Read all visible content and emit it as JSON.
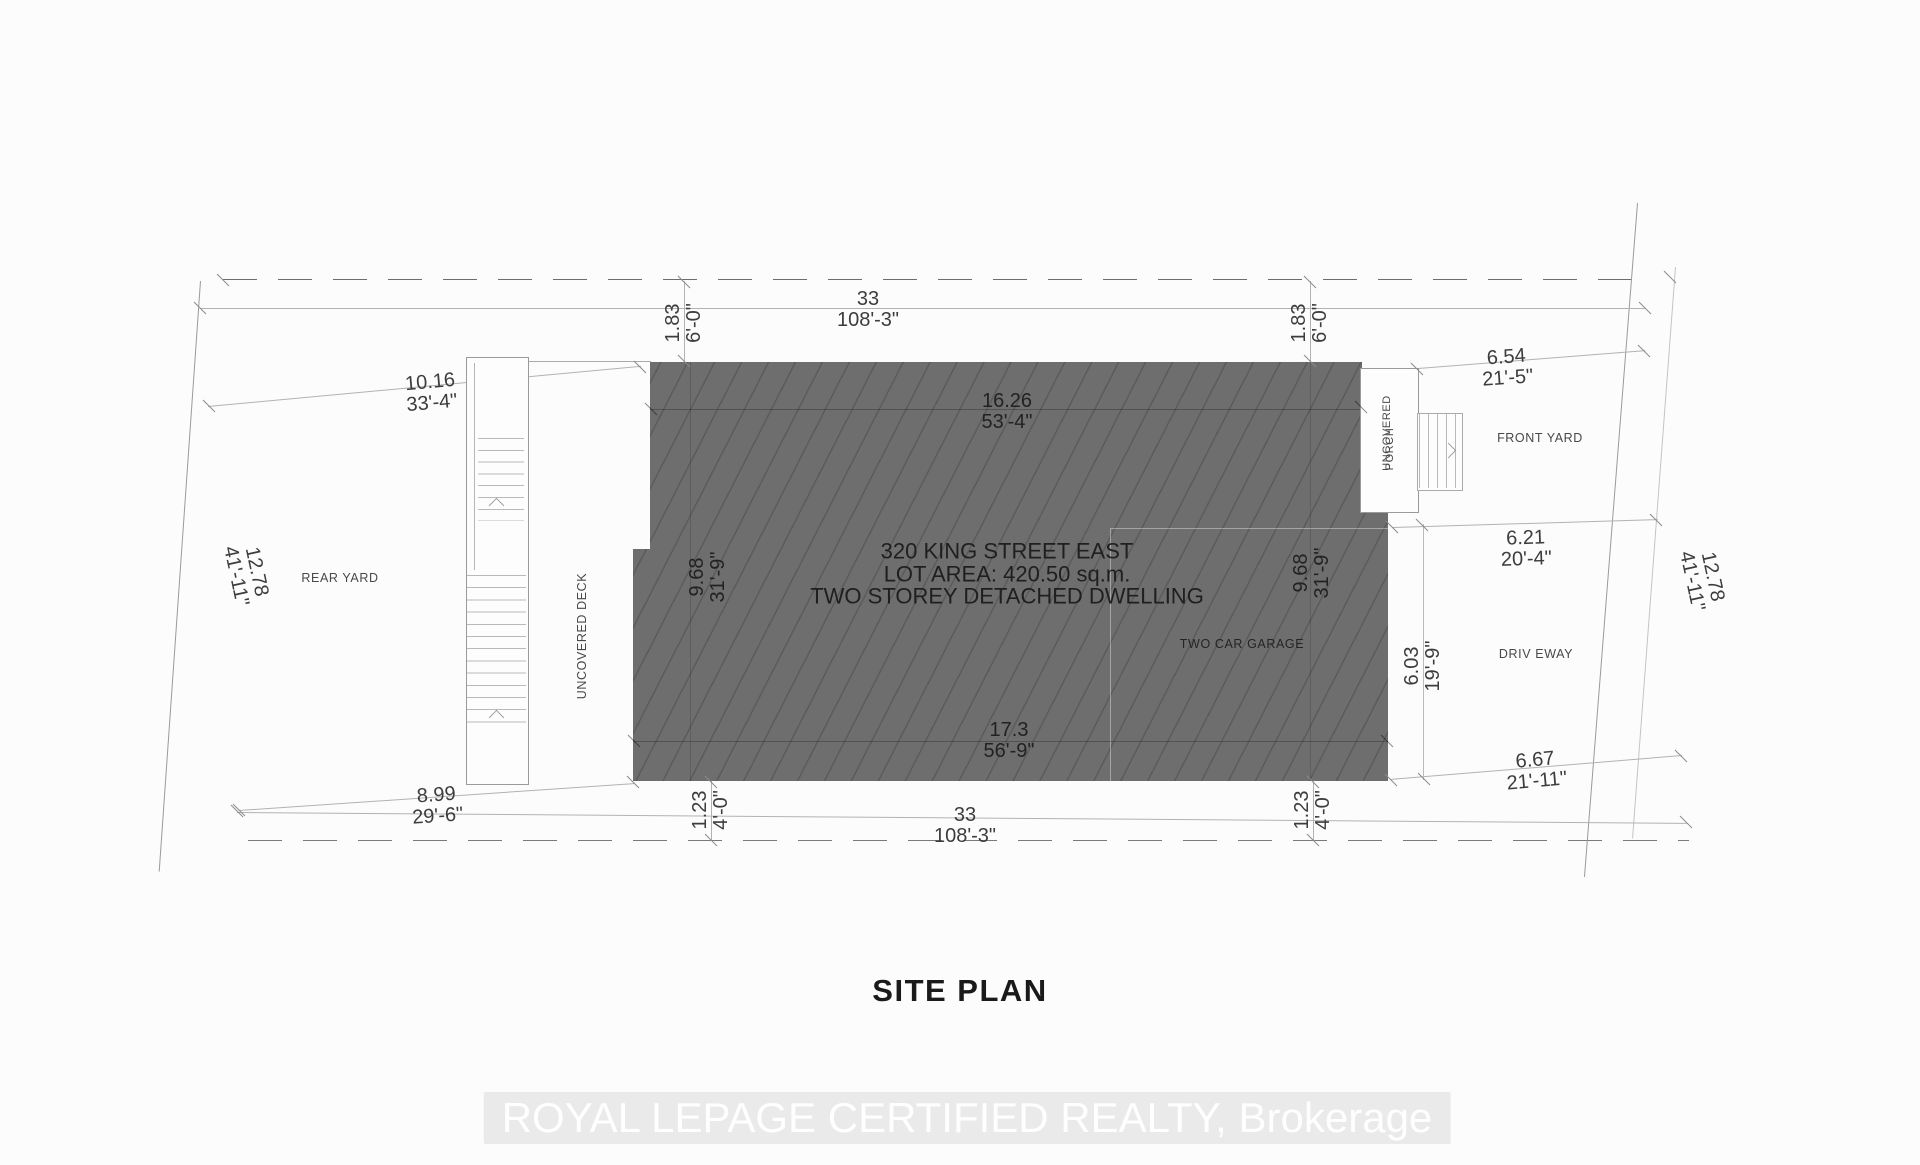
{
  "title": "SITE PLAN",
  "watermark": "ROYAL LEPAGE CERTIFIED REALTY, Brokerage",
  "building": {
    "address": "320 KING STREET EAST",
    "lot_area": "LOT AREA: 420.50 sq.m.",
    "description": "TWO STOREY DETACHED DWELLING",
    "garage_label": "TWO CAR GARAGE"
  },
  "areas": {
    "rear_yard": "REAR YARD",
    "front_yard": "FRONT YARD",
    "driveway": "DRIV EWAY",
    "deck": "UNCOVERED DECK",
    "porch_label_1": "UNCOVERED",
    "porch_label_2": "PORCH"
  },
  "colors": {
    "building_fill": "#6e6e6e",
    "line_gray": "#9a9a9a",
    "text_gray": "#3d3d3d"
  },
  "dimensions": {
    "lot_width_top": {
      "metric": "33",
      "imperial": "108'-3\""
    },
    "lot_width_bottom": {
      "metric": "33",
      "imperial": "108'-3\""
    },
    "lot_depth_left": {
      "metric": "12.78",
      "imperial": "41'-11\""
    },
    "lot_depth_right": {
      "metric": "12.78",
      "imperial": "41'-11\""
    },
    "front_setback_left": {
      "metric": "1.83",
      "imperial": "6'-0\""
    },
    "front_setback_right": {
      "metric": "1.83",
      "imperial": "6'-0\""
    },
    "rear_deck_width": {
      "metric": "10.16",
      "imperial": "33'-4\""
    },
    "house_width_top": {
      "metric": "16.26",
      "imperial": "53'-4\""
    },
    "house_depth_left": {
      "metric": "9.68",
      "imperial": "31'-9\""
    },
    "house_depth_right": {
      "metric": "9.68",
      "imperial": "31'-9\""
    },
    "front_yard_top": {
      "metric": "6.54",
      "imperial": "21'-5\""
    },
    "front_yard_mid": {
      "metric": "6.21",
      "imperial": "20'-4\""
    },
    "garage_to_lot": {
      "metric": "6.03",
      "imperial": "19'-9\""
    },
    "rear_yard_bottom": {
      "metric": "8.99",
      "imperial": "29'-6\""
    },
    "side_setback_left": {
      "metric": "1.23",
      "imperial": "4'-0\""
    },
    "side_setback_right": {
      "metric": "1.23",
      "imperial": "4'-0\""
    },
    "house_width_bottom": {
      "metric": "17.3",
      "imperial": "56'-9\""
    },
    "driveway_bottom": {
      "metric": "6.67",
      "imperial": "21'-11\""
    }
  }
}
